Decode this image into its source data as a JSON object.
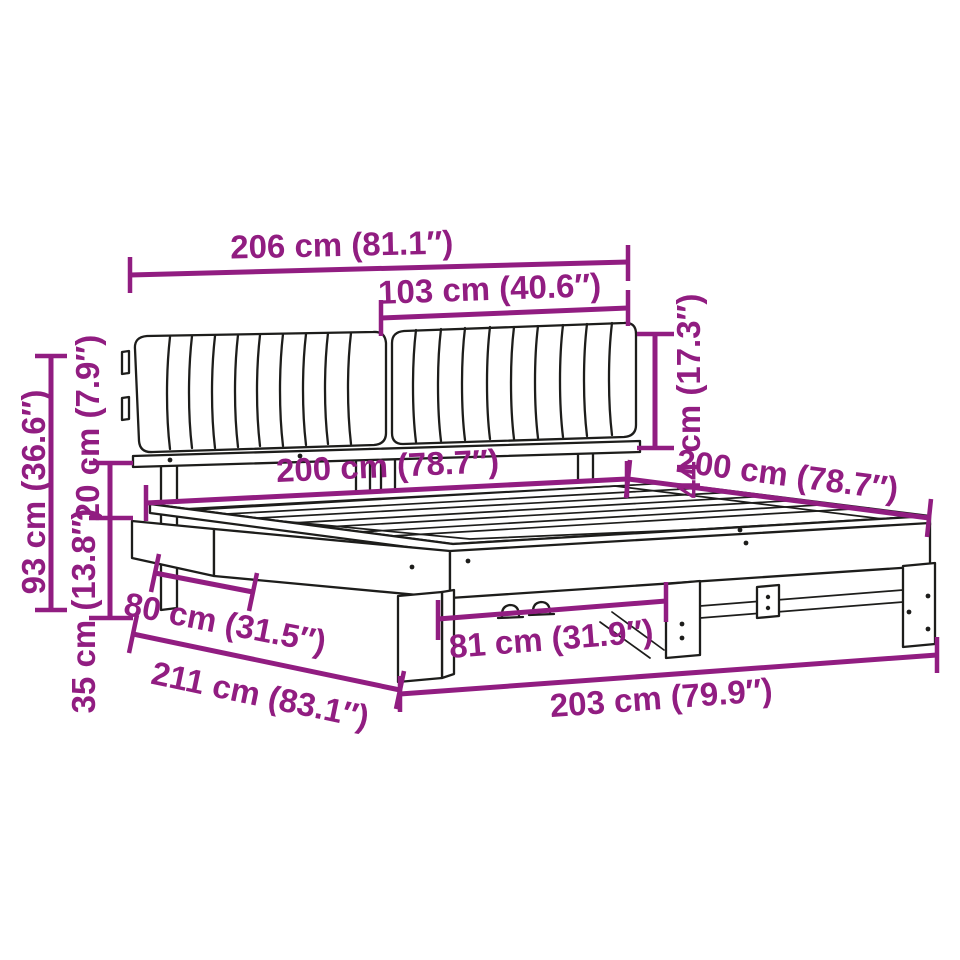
{
  "diagram": {
    "product": "bed-frame-with-channel-tufted-headboard",
    "colors": {
      "accent": "#911d81",
      "line": "#1d1d1b",
      "background": "#ffffff"
    },
    "dimensions": [
      {
        "id": "headboard-total-width",
        "label": "206 cm (81.1″)"
      },
      {
        "id": "headboard-panel-width",
        "label": "103 cm (40.6″)"
      },
      {
        "id": "headboard-cushion-height",
        "label": "44 cm (17.3″)"
      },
      {
        "id": "bed-width",
        "label": "200 cm (78.7″)"
      },
      {
        "id": "bed-length",
        "label": "200 cm (78.7″)"
      },
      {
        "id": "total-height",
        "label": "93 cm (36.6″)"
      },
      {
        "id": "headboard-clearance",
        "label": "20 cm (7.9″)"
      },
      {
        "id": "frame-height",
        "label": "35 cm (13.8″)"
      },
      {
        "id": "side-leg-offset",
        "label": "80 cm (31.5″)"
      },
      {
        "id": "front-leg-spacing",
        "label": "81 cm (31.9″)"
      },
      {
        "id": "total-depth",
        "label": "211 cm (83.1″)"
      },
      {
        "id": "base-length",
        "label": "203 cm (79.9″)"
      }
    ]
  }
}
